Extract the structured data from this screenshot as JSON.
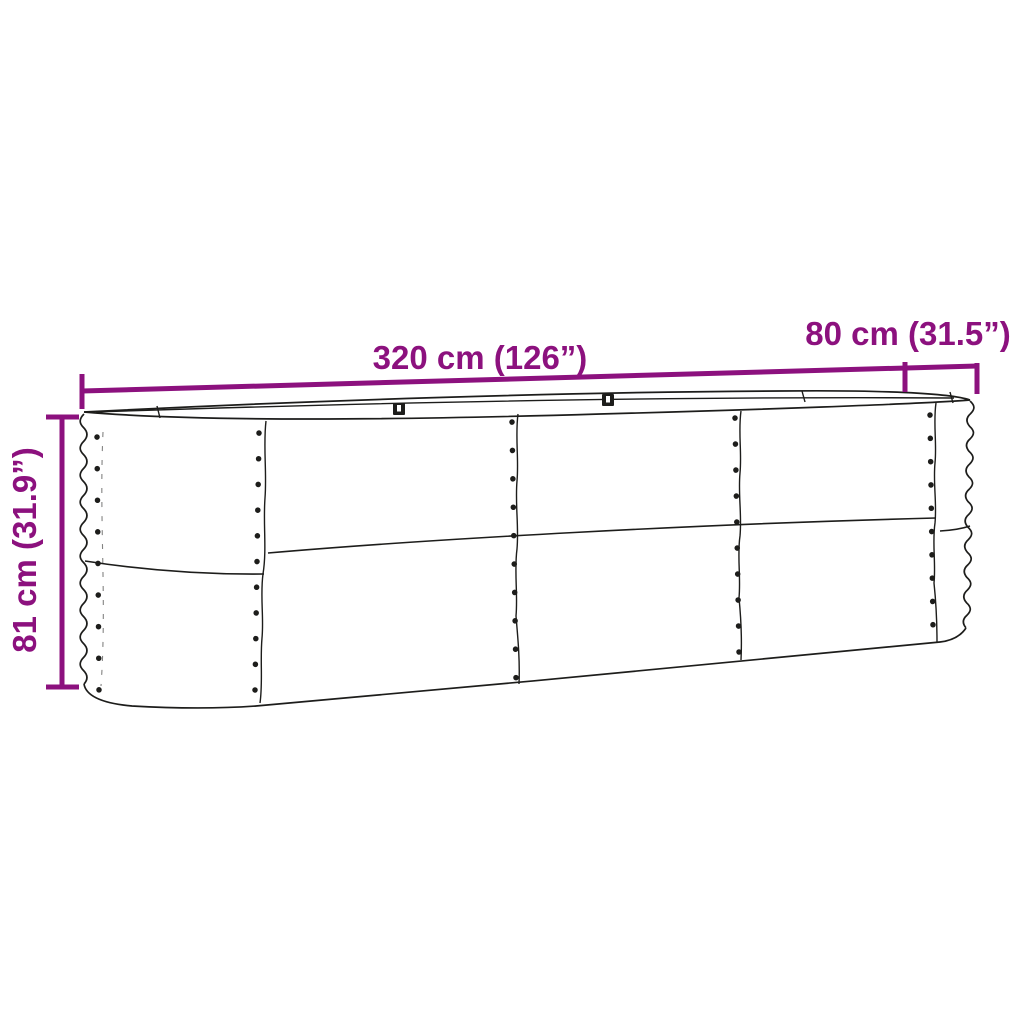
{
  "diagram": {
    "type": "product-dimension-diagram",
    "subject": "oval corrugated metal raised garden bed",
    "colors": {
      "accent": "#8C117E",
      "line": "#1D1D1B",
      "background": "#FFFFFF"
    },
    "dimensions": {
      "length": {
        "label": "320 cm (126”)",
        "cm": 320,
        "inches": 126
      },
      "width": {
        "label": "80 cm (31.5”)",
        "cm": 80,
        "inches": 31.5
      },
      "height": {
        "label": "81 cm (31.9”)",
        "cm": 81,
        "inches": 31.9
      }
    }
  }
}
